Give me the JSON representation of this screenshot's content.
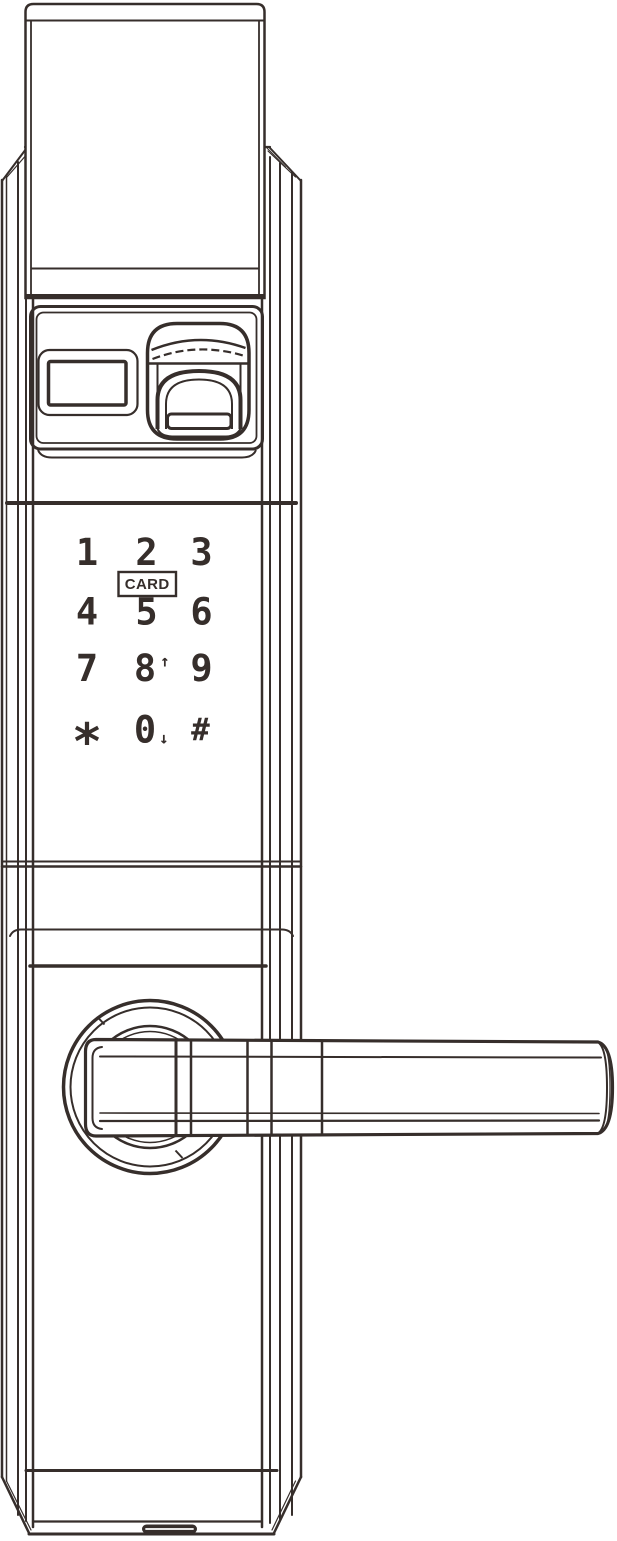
{
  "lock": {
    "keypad": {
      "card_label": "CARD",
      "rows": [
        {
          "keys": [
            {
              "label": "1"
            },
            {
              "label": "2"
            },
            {
              "label": "3"
            }
          ]
        },
        {
          "keys": [
            {
              "label": "4"
            },
            {
              "label": "5"
            },
            {
              "label": "6"
            }
          ]
        },
        {
          "keys": [
            {
              "label": "7"
            },
            {
              "label": "8",
              "suffix": "↑"
            },
            {
              "label": "9"
            }
          ]
        },
        {
          "keys": [
            {
              "label": "*"
            },
            {
              "label": "0",
              "suffix": "↓"
            },
            {
              "label": "#"
            }
          ]
        }
      ]
    }
  },
  "colors": {
    "line": "#362e2b",
    "background": "#ffffff"
  }
}
